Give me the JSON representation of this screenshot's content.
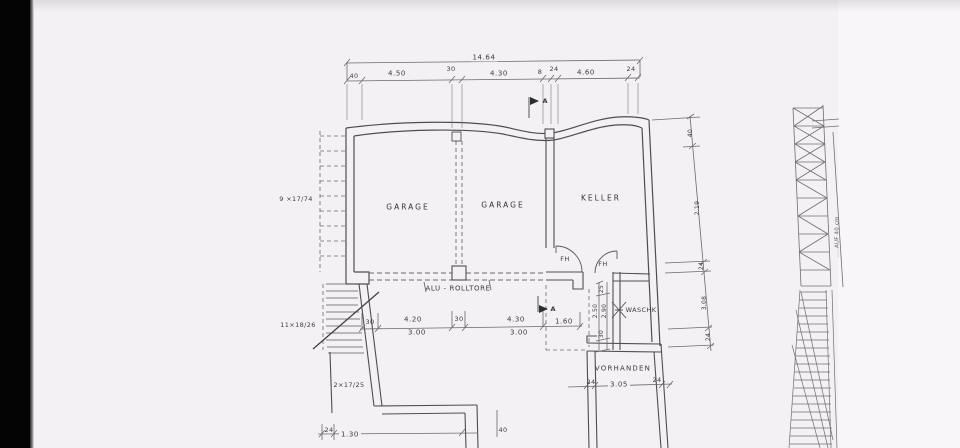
{
  "palette": {
    "page": "#f3f1f4",
    "side_bar": "#040404",
    "line": "#4f4e4f",
    "dim_line": "#6a696a",
    "text": "#3c3b3c"
  },
  "rooms": {
    "garage1": "GARAGE",
    "garage2": "GARAGE",
    "keller": "KELLER",
    "waschk": "WASCHK",
    "vorhanden": "VORHANDEN"
  },
  "doors": {
    "fh1": "FH",
    "fh2": "FH"
  },
  "notes": {
    "rolltore": "ALU - ROLLTORE",
    "stair_upper": "9 ×17/74",
    "stair_lower": "11×18/26",
    "stair_exit": "2×17/25",
    "side_note": ".....AUF  40 cm"
  },
  "markers": {
    "section_top": "A",
    "section_bottom": "A"
  },
  "dimensions": {
    "top_total": "14.64",
    "top_chain": [
      "40",
      "4.50",
      "30",
      "4.30",
      "8",
      "24",
      "4.60",
      "24"
    ],
    "right_chain": [
      "40",
      "2.19",
      "24",
      "3.08",
      "24"
    ],
    "bottom_chain": [
      "30",
      "4.20",
      "30",
      "4.30",
      "1.60"
    ],
    "bottom_clear": [
      "3.00",
      "3.00"
    ],
    "waschk_chain": [
      "25",
      "2.50",
      "2.90",
      "30"
    ],
    "vorhanden_chain": [
      "24",
      "3.05",
      "24"
    ],
    "lower_left_chain": [
      "24",
      "1.30",
      "40"
    ]
  }
}
